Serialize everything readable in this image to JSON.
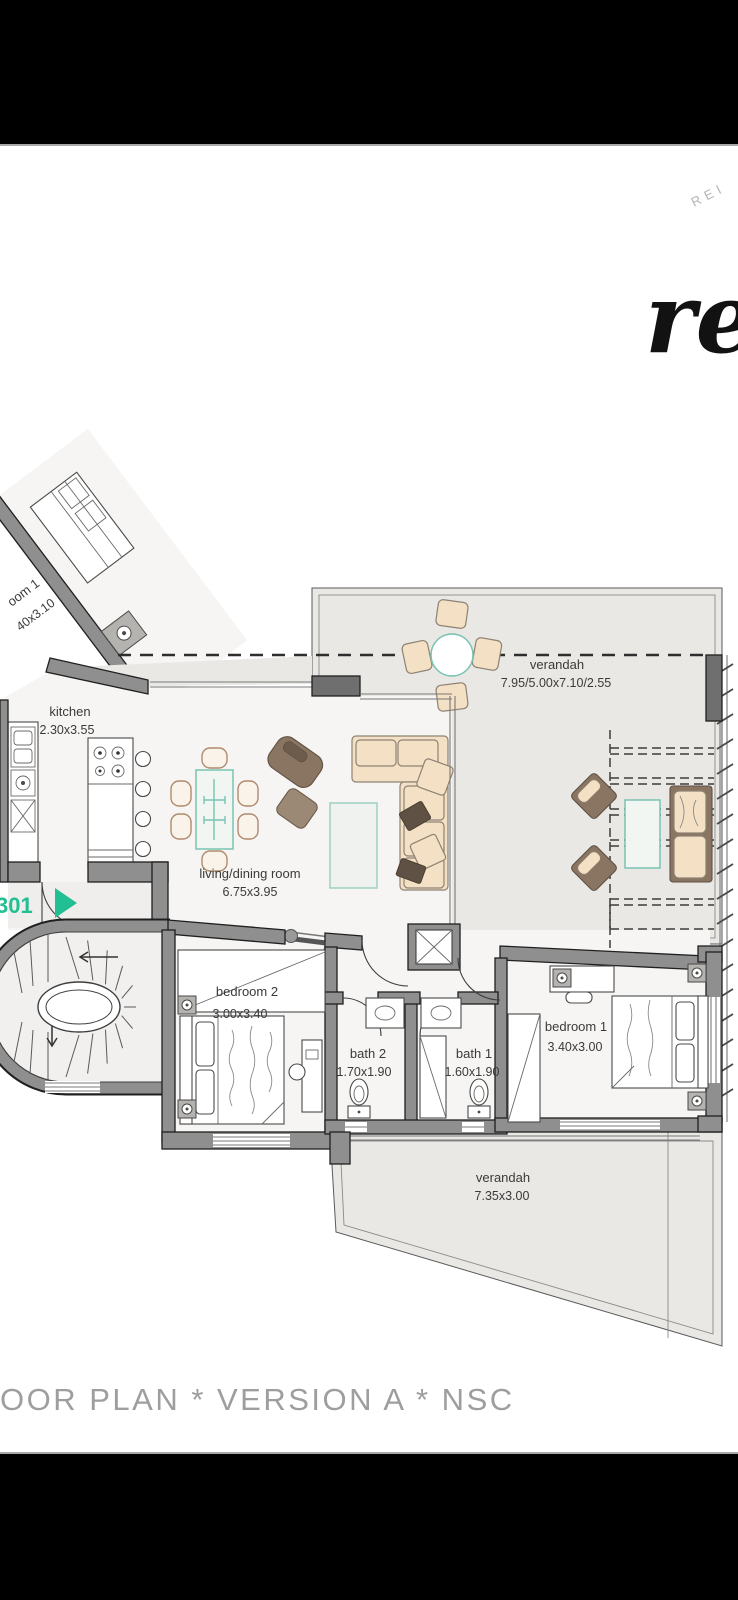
{
  "watermarks": {
    "corner_text": "REI",
    "script_text": "re"
  },
  "entrance": {
    "unit_number": "301"
  },
  "rooms": {
    "kitchen": {
      "name": "kitchen",
      "dims": "2.30x3.55"
    },
    "living": {
      "name": "living/dining room",
      "dims": "6.75x3.95"
    },
    "verandah_top": {
      "name": "verandah",
      "dims": "7.95/5.00x7.10/2.55"
    },
    "bedroom2": {
      "name": "bedroom 2",
      "dims": "3.00x3.40"
    },
    "bath2": {
      "name": "bath 2",
      "dims": "1.70x1.90"
    },
    "bath1": {
      "name": "bath 1",
      "dims": "1.60x1.90"
    },
    "bedroom1": {
      "name": "bedroom 1",
      "dims": "3.40x3.00"
    },
    "verandah_bottom": {
      "name": "verandah",
      "dims": "7.35x3.00"
    },
    "neighbor_unit": {
      "name": "oom 1",
      "dims": "40x3.10"
    }
  },
  "footer": {
    "caption": "OOR PLAN * VERSION A * NSC"
  },
  "colors": {
    "page_bg": "#ffffff",
    "letterbox_bar": "#000000",
    "wall": "#8f8f8f",
    "wall_outline": "#1f1f1f",
    "interior_floor": "#f6f5f3",
    "verandah_floor": "#e9e8e4",
    "accent_teal": "#79c3b2",
    "entrance_green": "#22bf92",
    "furniture_beige": "#f4e0c4",
    "furniture_brown": "#8a7462",
    "label_text": "#3a3a3a",
    "caption_text": "#9e9e9e",
    "watermark": "#b5b5b5"
  }
}
